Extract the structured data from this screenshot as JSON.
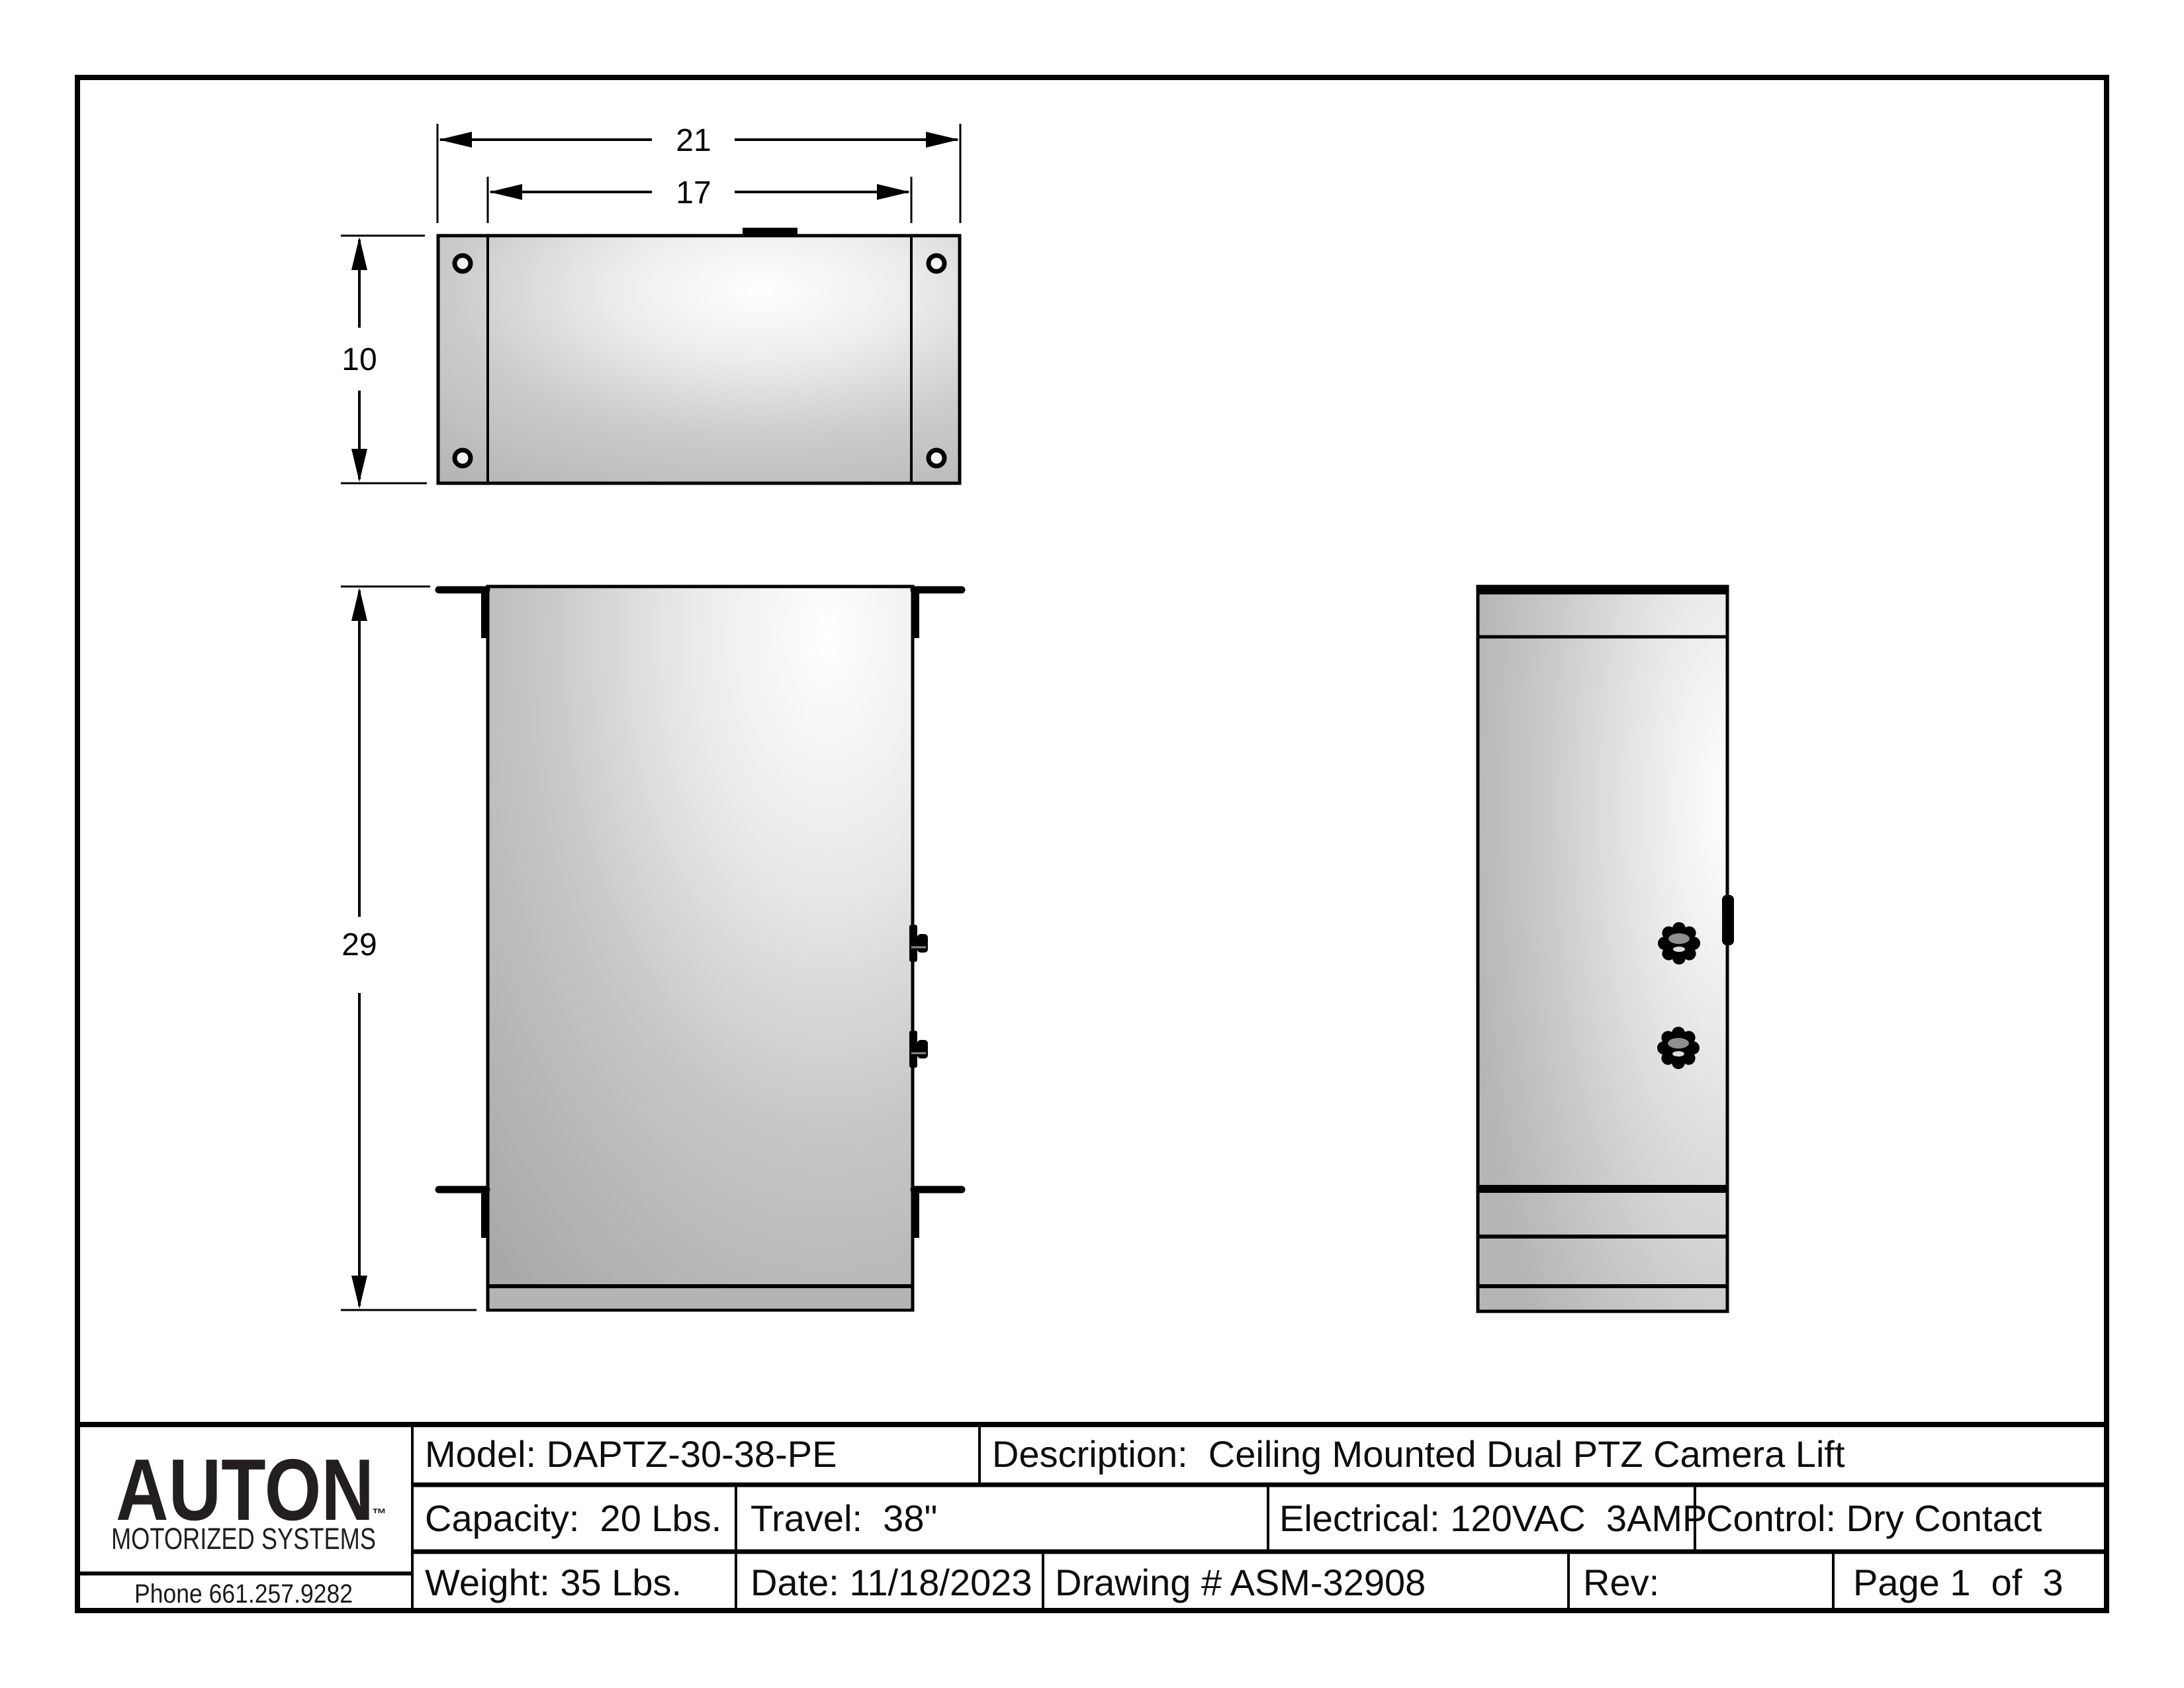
{
  "sheet": {
    "kind": "engineering-drawing",
    "views": [
      "top-view",
      "front-view",
      "side-view"
    ]
  },
  "dimensions": {
    "overall_width": "21",
    "body_width": "17",
    "depth": "10",
    "height": "29"
  },
  "title_block": {
    "model": "Model: DAPTZ-30-38-PE",
    "description": "Description:  Ceiling Mounted Dual PTZ Camera Lift",
    "capacity": "Capacity:  20 Lbs.",
    "travel": "Travel:  38\"",
    "electrical": "Electrical: 120VAC  3AMP",
    "control": "Control: Dry Contact",
    "weight": "Weight: 35 Lbs.",
    "date": "Date: 11/18/2023",
    "drawing_number": "Drawing # ASM-32908",
    "rev": "Rev:",
    "page": "Page 1  of  3",
    "logo": {
      "brand": "AUTON",
      "trademark": "™",
      "tagline": "MOTORIZED SYSTEMS",
      "phone": "Phone 661.257.9282"
    }
  },
  "colors": {
    "ink": "#000000",
    "logo_ink": "#231f20",
    "panel_gray": "#b8b8b8",
    "panel_highlight": "#ffffff",
    "strip_gray": "#b4b4b4",
    "background": "#ffffff"
  }
}
